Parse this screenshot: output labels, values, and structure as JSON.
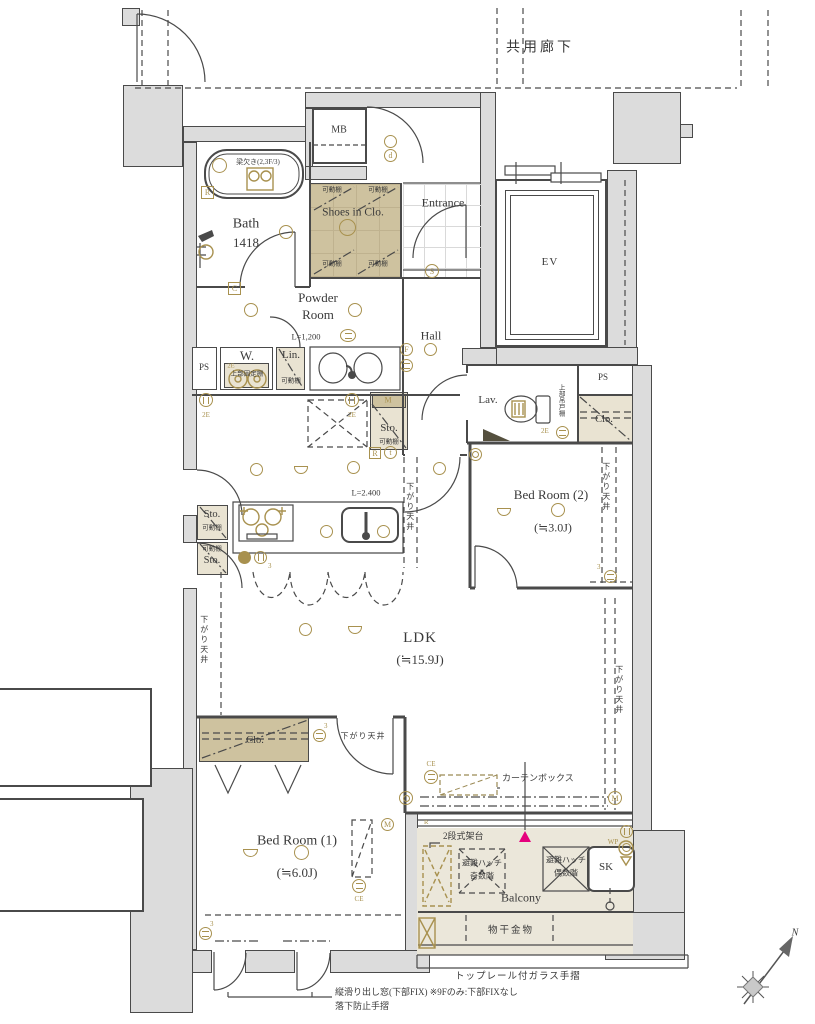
{
  "title": "マンション間取り図",
  "areas": {
    "corridor": "共用廊下",
    "mb": "MB",
    "ev": "EV",
    "bath": {
      "n": "Bath",
      "s": "1418",
      "beam": "梁欠き(2,3F/3)"
    },
    "shoes": {
      "n": "Shoes in Clo."
    },
    "entrance": {
      "n": "Entrance"
    },
    "powder": {
      "n1": "Powder",
      "n2": "Room",
      "counter": "L=1,200"
    },
    "hall": {
      "n": "Hall"
    },
    "w": {
      "n": "W.",
      "shelf": "上部固定棚"
    },
    "lin": {
      "n": "Lin."
    },
    "ps": "PS",
    "lav": {
      "n": "Lav.",
      "cab": "上部吊戸棚"
    },
    "sto": "Sto.",
    "clo": "Clo.",
    "bed2": {
      "n": "Bed Room (2)",
      "s": "(≒3.0J)"
    },
    "ldk": {
      "n": "LDK",
      "s": "(≒15.9J)",
      "ceil": "L=2.400"
    },
    "bed1": {
      "n": "Bed Room (1)",
      "s": "(≒6.0J)"
    },
    "balcony": {
      "n": "Balcony",
      "sk": "SK"
    }
  },
  "notes": {
    "shelf": "可動棚",
    "down": "下がり天井",
    "curtain": "カーテンボックス",
    "stand": "2段式架台",
    "hatch": "避難ハッチ",
    "odd": "奇数階",
    "even": "偶数階",
    "laundry": "物干金物",
    "rail": "トップレール付ガラス手摺",
    "win": "縦滑り出し窓(下部FIX) ※9Fのみ:下部FIXなし",
    "fall": "落下防止手摺"
  },
  "sym": {
    "d": "d",
    "s": "S",
    "f": "F",
    "c": "C",
    "r": "R",
    "t": "t",
    "m": "M",
    "wp": "WP",
    "ce": "CE",
    "e2": "2E",
    "n3": "3",
    "n": "N"
  },
  "colors": {
    "wall": "#dcdcdc",
    "line": "#4a4a4a",
    "closet": "#cec29f",
    "closet_light": "#e9e3d2",
    "bronze": "#a8914f",
    "balcony": "#ebe7da",
    "accent": "#e5007d"
  }
}
